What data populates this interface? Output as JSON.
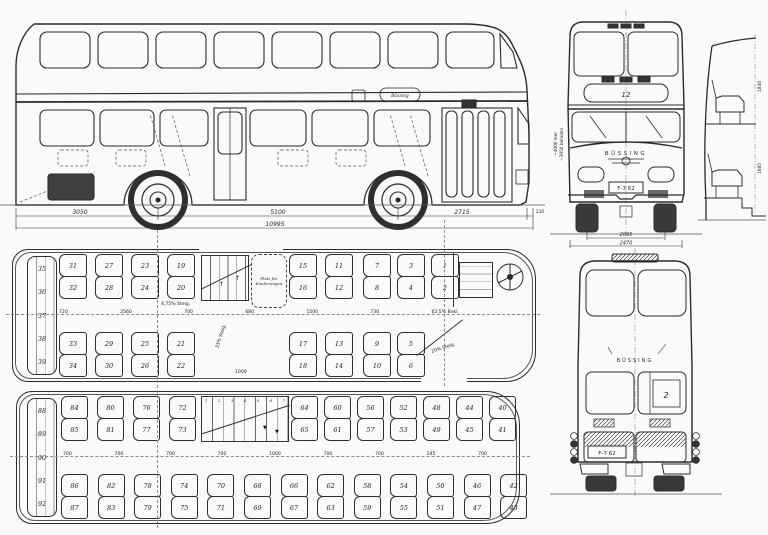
{
  "side_view": {
    "badge": "Büssing",
    "dim_rear_overhang": "3050",
    "dim_wheelbase": "5100",
    "dim_front_overhang": "2715",
    "dim_bumper": "130",
    "dim_total": "10995"
  },
  "front_view": {
    "destination_sign": "12",
    "brand": "BÜSSING",
    "license_plate": "F-7 62",
    "dim_track": "2095",
    "dim_width": "2470",
    "height_label_1": "~4000 leer",
    "height_label_2": "~3950 beladen"
  },
  "section_view": {
    "dim_upper_height": "1840",
    "dim_lower_height": "1685"
  },
  "rear_view": {
    "brand": "BÜSSING",
    "route_number": "2",
    "license_plate": "F-7 62"
  },
  "lower_deck": {
    "bench_seats": [
      "35",
      "36",
      "37",
      "38",
      "39"
    ],
    "top_rear_pairs": [
      [
        "31",
        "32"
      ],
      [
        "27",
        "28"
      ],
      [
        "23",
        "24"
      ],
      [
        "19",
        "20"
      ]
    ],
    "top_mid_pairs": [
      [
        "15",
        "16"
      ],
      [
        "11",
        "12"
      ]
    ],
    "top_front_pairs": [
      [
        "7",
        "8"
      ],
      [
        "3",
        "4"
      ],
      [
        "1",
        "2"
      ]
    ],
    "bottom_rear_pairs": [
      [
        "33",
        "34"
      ],
      [
        "29",
        "30"
      ],
      [
        "25",
        "26"
      ],
      [
        "21",
        "22"
      ]
    ],
    "bottom_mid_pairs": [
      [
        "17",
        "18"
      ],
      [
        "13",
        "14"
      ]
    ],
    "bottom_front_pairs": [
      [
        "9",
        "10"
      ],
      [
        "5",
        "6"
      ]
    ],
    "pram_label": "Platz für Kinderwagen",
    "ramp_note": "4,75% Steig.",
    "stair_note": "33% Steig.",
    "door_note": "20% Steig.",
    "mid_dims": [
      "720",
      "2560",
      "700",
      "680",
      "1500",
      "730",
      "62,5% Bekl."
    ],
    "bottom_dim": "1000"
  },
  "upper_deck": {
    "bench_seats": [
      "88",
      "89",
      "90",
      "91",
      "92"
    ],
    "top_rear_pairs": [
      [
        "84",
        "85"
      ],
      [
        "80",
        "81"
      ],
      [
        "76",
        "77"
      ],
      [
        "72",
        "73"
      ]
    ],
    "top_front_pairs": [
      [
        "64",
        "65"
      ],
      [
        "60",
        "61"
      ],
      [
        "56",
        "57"
      ],
      [
        "52",
        "53"
      ],
      [
        "48",
        "49"
      ],
      [
        "44",
        "45"
      ],
      [
        "40",
        "41"
      ]
    ],
    "bottom_pairs": [
      [
        "86",
        "87"
      ],
      [
        "82",
        "83"
      ],
      [
        "78",
        "79"
      ],
      [
        "74",
        "75"
      ],
      [
        "70",
        "71"
      ],
      [
        "68",
        "69"
      ],
      [
        "66",
        "67"
      ],
      [
        "62",
        "63"
      ],
      [
        "58",
        "59"
      ],
      [
        "54",
        "55"
      ],
      [
        "50",
        "51"
      ],
      [
        "46",
        "47"
      ],
      [
        "42",
        "43"
      ]
    ],
    "stair_steps": [
      "1",
      "2",
      "3",
      "4",
      "5",
      "6",
      "7"
    ],
    "mid_dims": [
      "700",
      "700",
      "700",
      "700",
      "1000",
      "700",
      "700",
      "245",
      "700"
    ]
  }
}
